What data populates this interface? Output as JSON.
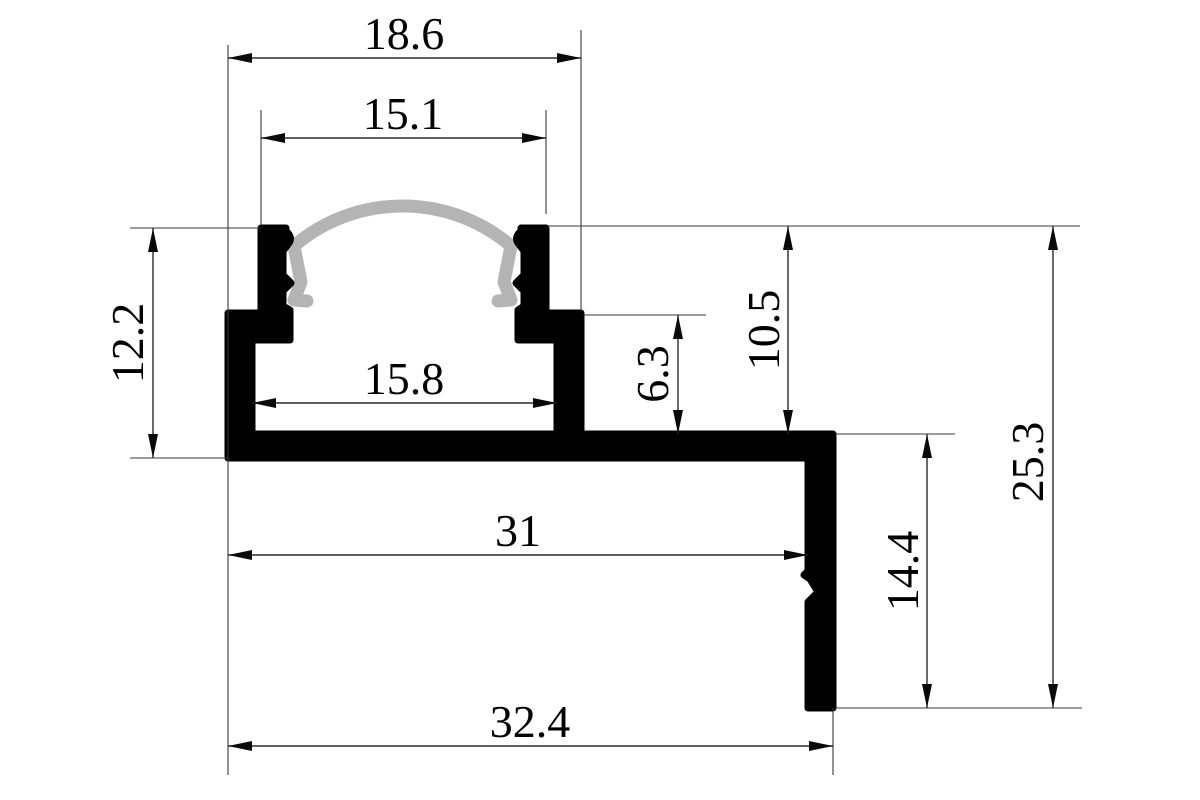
{
  "drawing": {
    "description": "Dimensioned technical cross-section drawing of an aluminum LED strip profile with curved diffuser cover",
    "units": "mm",
    "colors": {
      "profile_fill": "#000000",
      "diffuser_gray": "#b4b4b4",
      "dimension_lines": "#2b2b2b",
      "background": "#ffffff"
    },
    "dimensions": {
      "top_outer_width": "18.6",
      "top_wall_width": "15.1",
      "left_height": "12.2",
      "cavity_width": "15.8",
      "step_height": "6.3",
      "upper_channel_height": "10.5",
      "overall_height": "25.3",
      "base_width": "31",
      "leg_height": "14.4",
      "overall_width": "32.4"
    }
  }
}
